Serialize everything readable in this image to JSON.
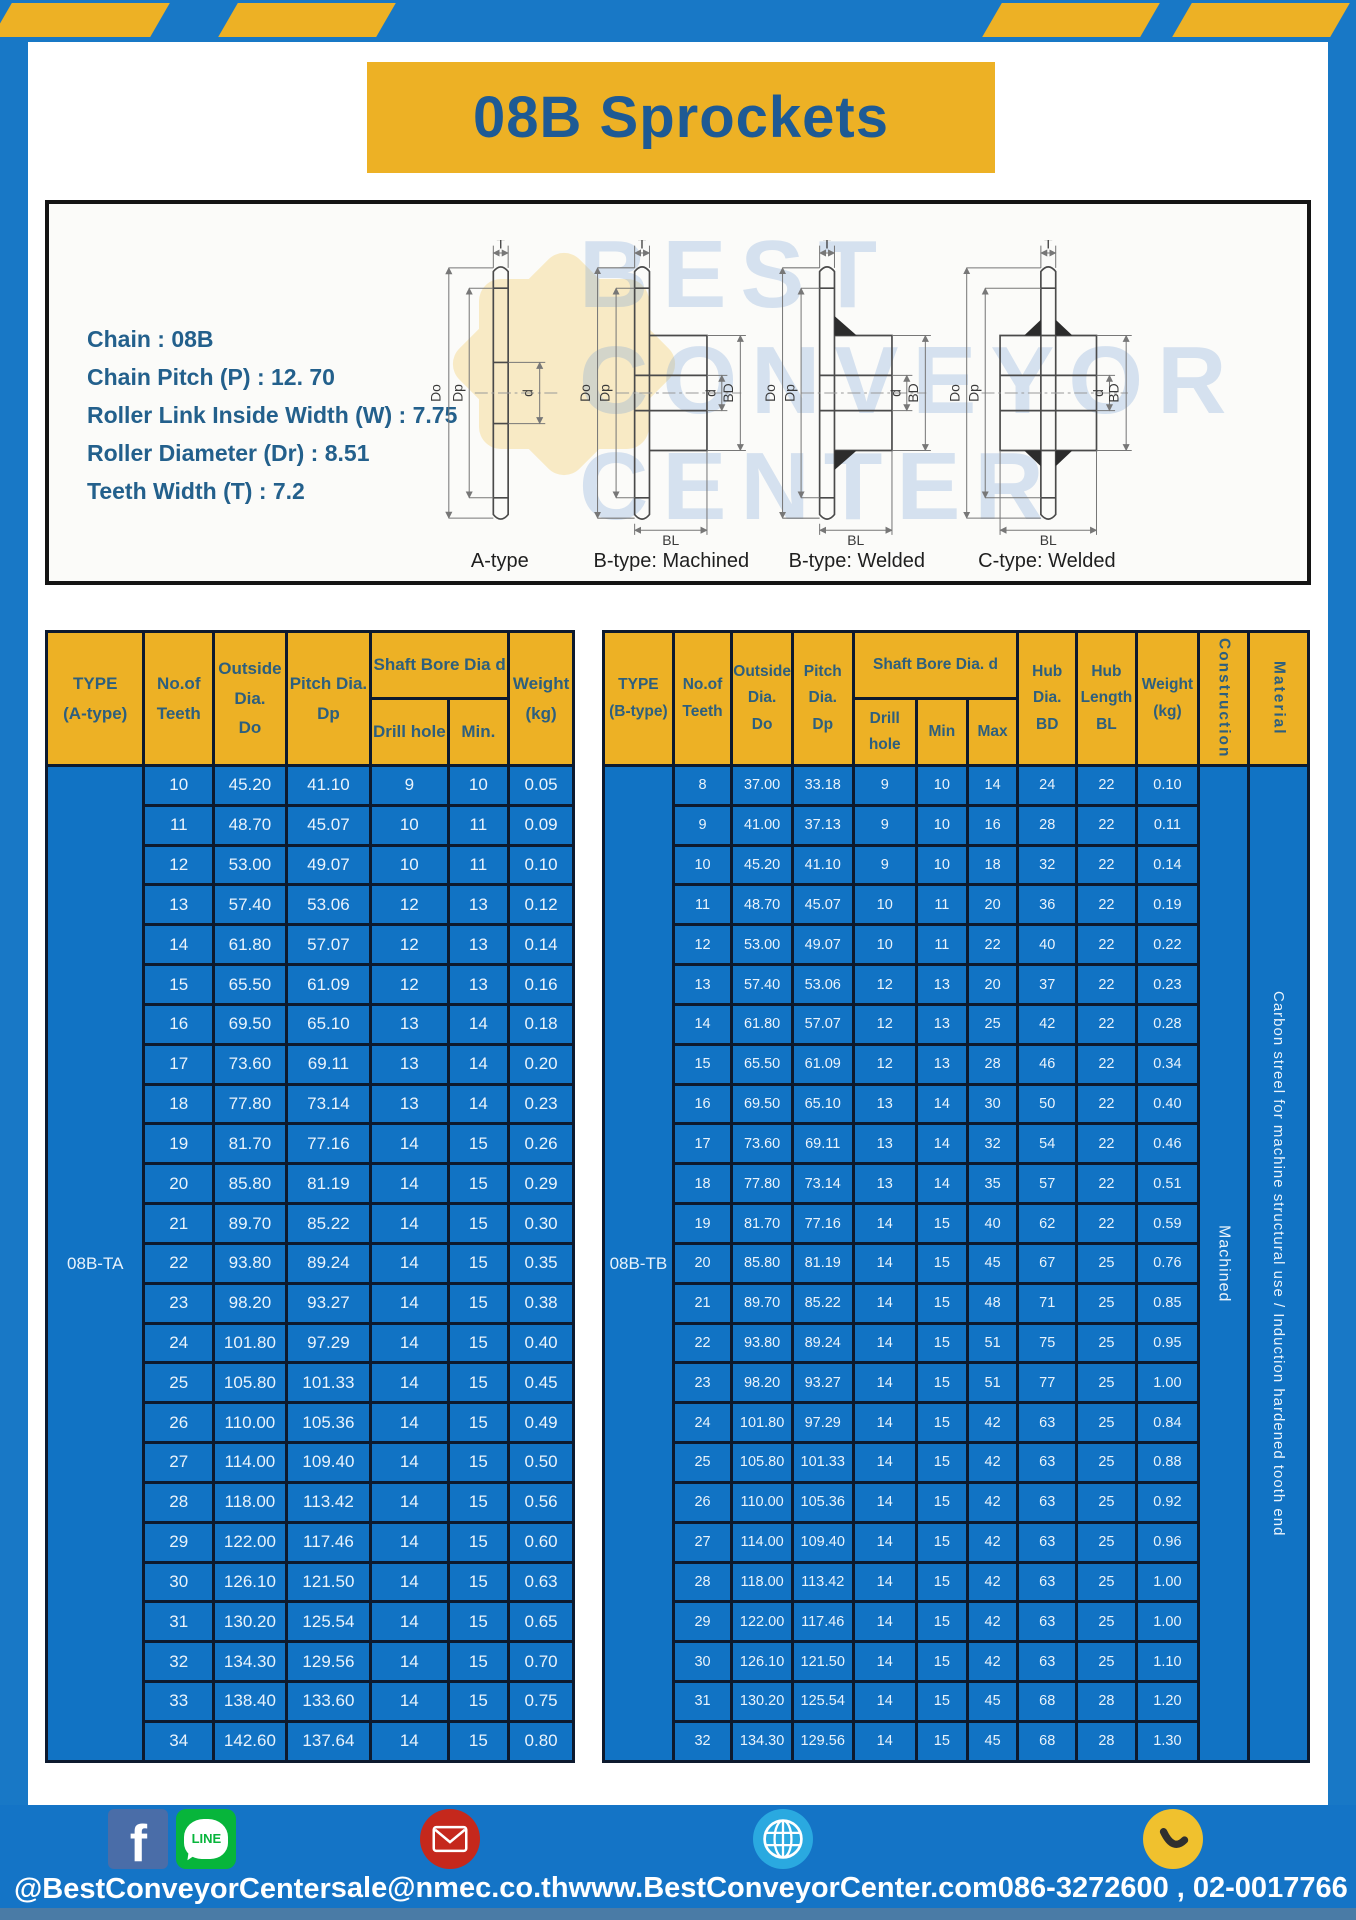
{
  "title": "08B Sprockets",
  "specs": [
    "Chain : 08B",
    "Chain Pitch (P) : 12. 70",
    "Roller Link Inside Width (W) : 7.75",
    "Roller Diameter (Dr) : 8.51",
    "Teeth Width (T) : 7.2"
  ],
  "diagram": {
    "captions": [
      "A-type",
      "B-type: Machined",
      "B-type: Welded",
      "C-type: Welded"
    ],
    "labels": {
      "t": "T",
      "do": "Do",
      "dp": "Dp",
      "d": "d",
      "bd": "BD",
      "bl": "BL"
    },
    "watermark": [
      "BEST",
      "CONVEYOR",
      "CENTER"
    ]
  },
  "left_table": {
    "type_label": "08B-TA",
    "headers": {
      "type": "TYPE\n(A-type)",
      "teeth": "No.of\nTeeth",
      "outside": "Outside\nDia.\nDo",
      "pitch": "Pitch Dia.\nDp",
      "shaft": "Shaft Bore Dia d",
      "drill": "Drill hole",
      "min": "Min.",
      "weight": "Weight\n(kg)"
    },
    "rows": [
      [
        "10",
        "45.20",
        "41.10",
        "9",
        "10",
        "0.05"
      ],
      [
        "11",
        "48.70",
        "45.07",
        "10",
        "11",
        "0.09"
      ],
      [
        "12",
        "53.00",
        "49.07",
        "10",
        "11",
        "0.10"
      ],
      [
        "13",
        "57.40",
        "53.06",
        "12",
        "13",
        "0.12"
      ],
      [
        "14",
        "61.80",
        "57.07",
        "12",
        "13",
        "0.14"
      ],
      [
        "15",
        "65.50",
        "61.09",
        "12",
        "13",
        "0.16"
      ],
      [
        "16",
        "69.50",
        "65.10",
        "13",
        "14",
        "0.18"
      ],
      [
        "17",
        "73.60",
        "69.11",
        "13",
        "14",
        "0.20"
      ],
      [
        "18",
        "77.80",
        "73.14",
        "13",
        "14",
        "0.23"
      ],
      [
        "19",
        "81.70",
        "77.16",
        "14",
        "15",
        "0.26"
      ],
      [
        "20",
        "85.80",
        "81.19",
        "14",
        "15",
        "0.29"
      ],
      [
        "21",
        "89.70",
        "85.22",
        "14",
        "15",
        "0.30"
      ],
      [
        "22",
        "93.80",
        "89.24",
        "14",
        "15",
        "0.35"
      ],
      [
        "23",
        "98.20",
        "93.27",
        "14",
        "15",
        "0.38"
      ],
      [
        "24",
        "101.80",
        "97.29",
        "14",
        "15",
        "0.40"
      ],
      [
        "25",
        "105.80",
        "101.33",
        "14",
        "15",
        "0.45"
      ],
      [
        "26",
        "110.00",
        "105.36",
        "14",
        "15",
        "0.49"
      ],
      [
        "27",
        "114.00",
        "109.40",
        "14",
        "15",
        "0.50"
      ],
      [
        "28",
        "118.00",
        "113.42",
        "14",
        "15",
        "0.56"
      ],
      [
        "29",
        "122.00",
        "117.46",
        "14",
        "15",
        "0.60"
      ],
      [
        "30",
        "126.10",
        "121.50",
        "14",
        "15",
        "0.63"
      ],
      [
        "31",
        "130.20",
        "125.54",
        "14",
        "15",
        "0.65"
      ],
      [
        "32",
        "134.30",
        "129.56",
        "14",
        "15",
        "0.70"
      ],
      [
        "33",
        "138.40",
        "133.60",
        "14",
        "15",
        "0.75"
      ],
      [
        "34",
        "142.60",
        "137.64",
        "14",
        "15",
        "0.80"
      ]
    ]
  },
  "right_table": {
    "type_label": "08B-TB",
    "construction": "Machined",
    "material": "Carbon streel for machine structural use / Induction hardened tooth end",
    "headers": {
      "type": "TYPE\n(B-type)",
      "teeth": "No.of\nTeeth",
      "outside": "Outside\nDia.\nDo",
      "pitch": "Pitch\nDia.\nDp",
      "shaft": "Shaft Bore Dia. d",
      "drill": "Drill hole",
      "min": "Min",
      "max": "Max",
      "hub_dia": "Hub\nDia.\nBD",
      "hub_length": "Hub\nLength\nBL",
      "weight": "Weight\n(kg)",
      "construction": "Construction",
      "material": "Material"
    },
    "rows": [
      [
        "8",
        "37.00",
        "33.18",
        "9",
        "10",
        "14",
        "24",
        "22",
        "0.10"
      ],
      [
        "9",
        "41.00",
        "37.13",
        "9",
        "10",
        "16",
        "28",
        "22",
        "0.11"
      ],
      [
        "10",
        "45.20",
        "41.10",
        "9",
        "10",
        "18",
        "32",
        "22",
        "0.14"
      ],
      [
        "11",
        "48.70",
        "45.07",
        "10",
        "11",
        "20",
        "36",
        "22",
        "0.19"
      ],
      [
        "12",
        "53.00",
        "49.07",
        "10",
        "11",
        "22",
        "40",
        "22",
        "0.22"
      ],
      [
        "13",
        "57.40",
        "53.06",
        "12",
        "13",
        "20",
        "37",
        "22",
        "0.23"
      ],
      [
        "14",
        "61.80",
        "57.07",
        "12",
        "13",
        "25",
        "42",
        "22",
        "0.28"
      ],
      [
        "15",
        "65.50",
        "61.09",
        "12",
        "13",
        "28",
        "46",
        "22",
        "0.34"
      ],
      [
        "16",
        "69.50",
        "65.10",
        "13",
        "14",
        "30",
        "50",
        "22",
        "0.40"
      ],
      [
        "17",
        "73.60",
        "69.11",
        "13",
        "14",
        "32",
        "54",
        "22",
        "0.46"
      ],
      [
        "18",
        "77.80",
        "73.14",
        "13",
        "14",
        "35",
        "57",
        "22",
        "0.51"
      ],
      [
        "19",
        "81.70",
        "77.16",
        "14",
        "15",
        "40",
        "62",
        "22",
        "0.59"
      ],
      [
        "20",
        "85.80",
        "81.19",
        "14",
        "15",
        "45",
        "67",
        "25",
        "0.76"
      ],
      [
        "21",
        "89.70",
        "85.22",
        "14",
        "15",
        "48",
        "71",
        "25",
        "0.85"
      ],
      [
        "22",
        "93.80",
        "89.24",
        "14",
        "15",
        "51",
        "75",
        "25",
        "0.95"
      ],
      [
        "23",
        "98.20",
        "93.27",
        "14",
        "15",
        "51",
        "77",
        "25",
        "1.00"
      ],
      [
        "24",
        "101.80",
        "97.29",
        "14",
        "15",
        "42",
        "63",
        "25",
        "0.84"
      ],
      [
        "25",
        "105.80",
        "101.33",
        "14",
        "15",
        "42",
        "63",
        "25",
        "0.88"
      ],
      [
        "26",
        "110.00",
        "105.36",
        "14",
        "15",
        "42",
        "63",
        "25",
        "0.92"
      ],
      [
        "27",
        "114.00",
        "109.40",
        "14",
        "15",
        "42",
        "63",
        "25",
        "0.96"
      ],
      [
        "28",
        "118.00",
        "113.42",
        "14",
        "15",
        "42",
        "63",
        "25",
        "1.00"
      ],
      [
        "29",
        "122.00",
        "117.46",
        "14",
        "15",
        "42",
        "63",
        "25",
        "1.00"
      ],
      [
        "30",
        "126.10",
        "121.50",
        "14",
        "15",
        "42",
        "63",
        "25",
        "1.10"
      ],
      [
        "31",
        "130.20",
        "125.54",
        "14",
        "15",
        "45",
        "68",
        "28",
        "1.20"
      ],
      [
        "32",
        "134.30",
        "129.56",
        "14",
        "15",
        "45",
        "68",
        "28",
        "1.30"
      ]
    ]
  },
  "footer": {
    "social_label": "@BestConveyorCenter",
    "line_text": "LINE",
    "email": "sale@nmec.co.th",
    "website": "www.BestConveyorCenter.com",
    "phones": "086-3272600 , 02-0017766"
  },
  "colors": {
    "accent_yellow": "#EDB125",
    "frame_blue": "#1878C6",
    "table_cell_blue": "#1173C4",
    "grid_line": "#0D1A2E",
    "header_text": "#2D5F7E",
    "title_text": "#1E5A94",
    "footer_blue": "#1474C6",
    "facebook_blue": "#4A6DA8",
    "line_green": "#07B53B",
    "mail_red": "#C5281C",
    "globe_blue": "#2AA9E0",
    "phone_yellow": "#F0C12E"
  }
}
